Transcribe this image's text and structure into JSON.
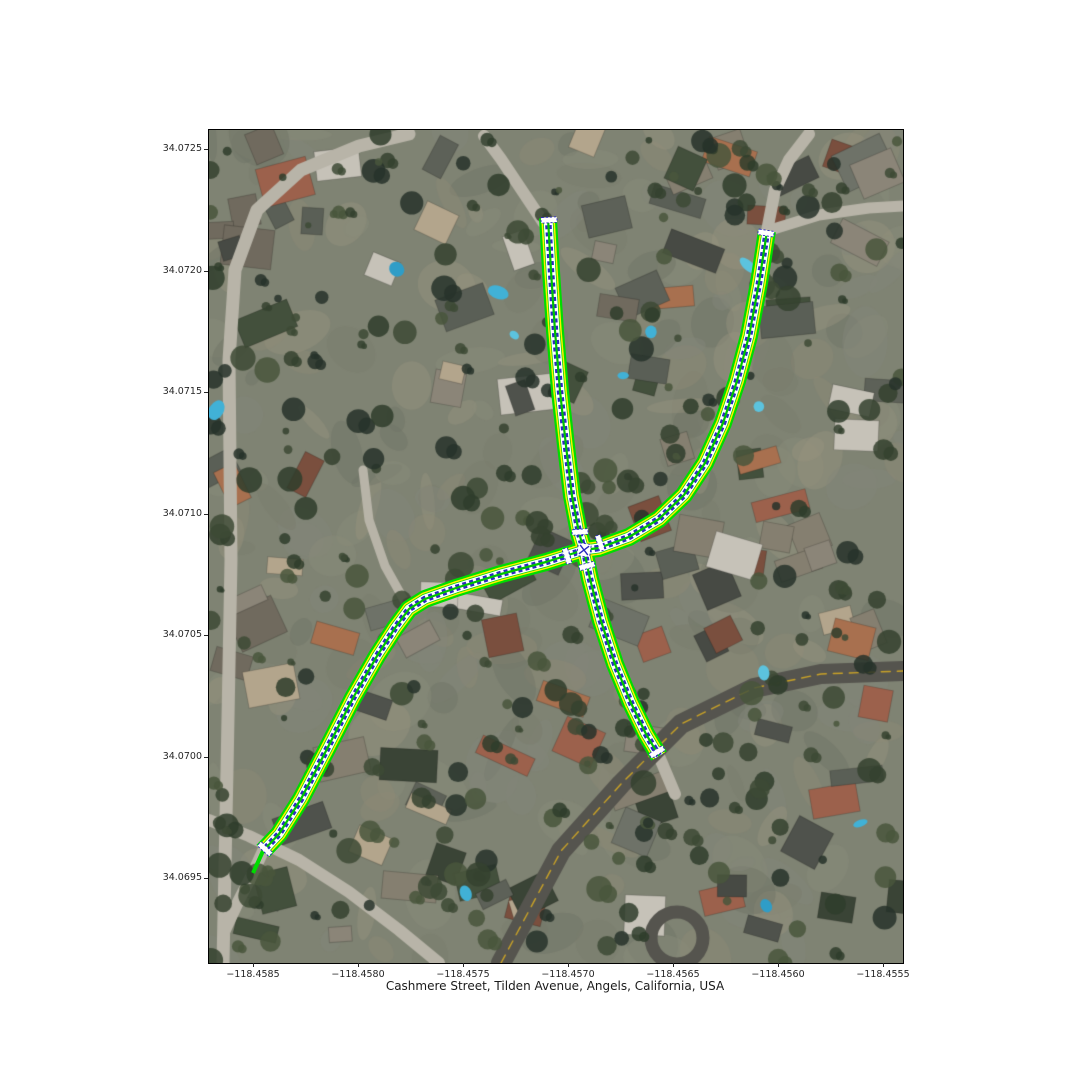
{
  "figure": {
    "title": "Cashmere Street, Tilden Avenue, Angels, California, USA"
  },
  "axes": {
    "x_ticks": [
      "−118.4585",
      "−118.4580",
      "−118.4575",
      "−118.4570",
      "−118.4565",
      "−118.4560",
      "−118.4555"
    ],
    "y_ticks": [
      "34.0725",
      "34.0720",
      "34.0715",
      "34.0710",
      "34.0705",
      "34.0700",
      "34.0695"
    ]
  },
  "map": {
    "overlay": {
      "colors": {
        "casing": "#00dc00",
        "stripe": "#ffef00",
        "lane": "#ffffff",
        "centerline": "#2a2ac0",
        "divider": "#00c400"
      },
      "roads": [
        {
          "id": "avenue-north",
          "points": [
            [
              339,
              88
            ],
            [
              342,
              141
            ],
            [
              346,
              201
            ],
            [
              351,
              261
            ],
            [
              357,
              316
            ],
            [
              363,
              366
            ],
            [
              370,
              403
            ],
            [
              375,
              420
            ]
          ]
        },
        {
          "id": "avenue-south",
          "points": [
            [
              375,
              420
            ],
            [
              381,
              449
            ],
            [
              392,
              491
            ],
            [
              406,
              534
            ],
            [
              422,
              573
            ],
            [
              437,
              604
            ],
            [
              450,
              626
            ]
          ]
        },
        {
          "id": "street-northeast",
          "points": [
            [
              558,
              101
            ],
            [
              550,
              153
            ],
            [
              540,
              206
            ],
            [
              528,
              251
            ],
            [
              514,
              293
            ],
            [
              496,
              333
            ],
            [
              475,
              365
            ],
            [
              450,
              389
            ],
            [
              420,
              407
            ],
            [
              390,
              418
            ],
            [
              375,
              420
            ]
          ]
        },
        {
          "id": "street-southwest",
          "points": [
            [
              375,
              420
            ],
            [
              337,
              432
            ],
            [
              292,
              444
            ],
            [
              247,
              458
            ],
            [
              216,
              469
            ],
            [
              200,
              479
            ],
            [
              186,
              498
            ],
            [
              168,
              526
            ],
            [
              144,
              568
            ],
            [
              118,
              619
            ],
            [
              92,
              669
            ],
            [
              70,
              704
            ],
            [
              54,
              721
            ]
          ]
        }
      ],
      "tail": [
        [
          54,
          721
        ],
        [
          44,
          743
        ]
      ],
      "markers": {
        "bars": [
          {
            "x": 340,
            "y": 90,
            "rot": -3
          },
          {
            "x": 557,
            "y": 103,
            "rot": 9
          },
          {
            "x": 448,
            "y": 622,
            "rot": -31
          },
          {
            "x": 56,
            "y": 719,
            "rot": 43
          },
          {
            "x": 371,
            "y": 402,
            "rot": -4
          },
          {
            "x": 378,
            "y": 436,
            "rot": -15
          },
          {
            "x": 391,
            "y": 413,
            "rot": 73
          },
          {
            "x": 358,
            "y": 426,
            "rot": 73
          }
        ],
        "center": {
          "x": 375,
          "y": 420,
          "rot": 8
        }
      }
    }
  }
}
